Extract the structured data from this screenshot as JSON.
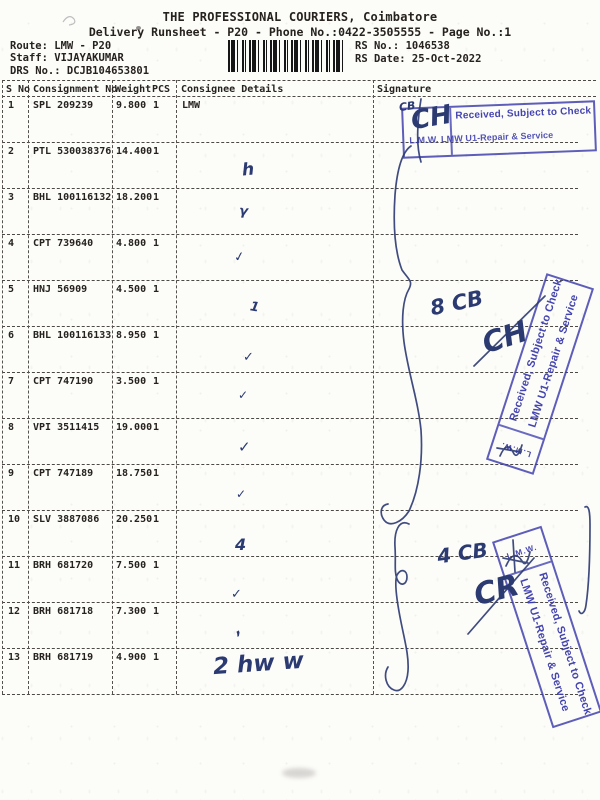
{
  "colors": {
    "stamp_blue": "#3a3aac",
    "ink_navy": "#2c3a72",
    "text": "#26221e"
  },
  "header": {
    "title": "THE PROFESSIONAL COURIERS, Coimbatore",
    "subtitle": "Delivery Runsheet - P20 - Phone No.:0422-3505555 - Page No.:1",
    "route": "Route: LMW - P20",
    "staff": "Staff: VIJAYAKUMAR",
    "drs_no": "DRS No.: DCJB104653801",
    "rs_no": "RS No.: 1046538",
    "rs_date": "RS Date: 25-Oct-2022"
  },
  "table": {
    "columns": [
      "S No",
      "Consignment No",
      "Weight",
      "PCS",
      "Consignee Details",
      "Signature"
    ],
    "rows": [
      {
        "sno": "1",
        "consignment": "SPL 209239",
        "weight": "9.800",
        "pcs": "1",
        "consignee": "LMW"
      },
      {
        "sno": "2",
        "consignment": "PTL 530038376",
        "weight": "14.400",
        "pcs": "1",
        "consignee": ""
      },
      {
        "sno": "3",
        "consignment": "BHL 100116132",
        "weight": "18.200",
        "pcs": "1",
        "consignee": ""
      },
      {
        "sno": "4",
        "consignment": "CPT 739640",
        "weight": "4.800",
        "pcs": "1",
        "consignee": ""
      },
      {
        "sno": "5",
        "consignment": "HNJ 56909",
        "weight": "4.500",
        "pcs": "1",
        "consignee": ""
      },
      {
        "sno": "6",
        "consignment": "BHL 100116133",
        "weight": "8.950",
        "pcs": "1",
        "consignee": ""
      },
      {
        "sno": "7",
        "consignment": "CPT 747190",
        "weight": "3.500",
        "pcs": "1",
        "consignee": ""
      },
      {
        "sno": "8",
        "consignment": "VPI 3511415",
        "weight": "19.000",
        "pcs": "1",
        "consignee": ""
      },
      {
        "sno": "9",
        "consignment": "CPT 747189",
        "weight": "18.750",
        "pcs": "1",
        "consignee": ""
      },
      {
        "sno": "10",
        "consignment": "SLV 3887086",
        "weight": "20.250",
        "pcs": "1",
        "consignee": ""
      },
      {
        "sno": "11",
        "consignment": "BRH 681720",
        "weight": "7.500",
        "pcs": "1",
        "consignee": ""
      },
      {
        "sno": "12",
        "consignment": "BRH 681718",
        "weight": "7.300",
        "pcs": "1",
        "consignee": ""
      },
      {
        "sno": "13",
        "consignment": "BRH 681719",
        "weight": "4.900",
        "pcs": "1",
        "consignee": ""
      }
    ]
  },
  "barcode": {
    "icon": "barcode-icon"
  },
  "stamps": {
    "stamp1": {
      "line1": "Received, Subject to Check",
      "line2": "L.M.W. LMW U1-Repair & Service"
    },
    "stamp2": {
      "line1": "Received, Subject to Check",
      "line2": "LMW U1-Repair & Service",
      "end_label": "L.M.W."
    },
    "stamp3": {
      "line1": "Received, Subject to Check",
      "line2": "LMW U1-Repair & Service",
      "end_label": "L.M.W."
    }
  },
  "handwriting": {
    "notes": [
      {
        "text": "CB",
        "x": 399,
        "y": 100,
        "size": 11,
        "rot": -8
      },
      {
        "text": "CH",
        "x": 411,
        "y": 103,
        "size": 26,
        "rot": -10
      },
      {
        "text": "8 CB",
        "x": 430,
        "y": 291,
        "size": 21,
        "rot": -12
      },
      {
        "text": "CH",
        "x": 482,
        "y": 320,
        "size": 29,
        "rot": -18
      },
      {
        "text": "4 CB",
        "x": 437,
        "y": 541,
        "size": 20,
        "rot": -8
      },
      {
        "text": "CR",
        "x": 474,
        "y": 573,
        "size": 30,
        "rot": -15
      },
      {
        "text": "2 hw w",
        "x": 213,
        "y": 651,
        "size": 23,
        "rot": -4
      }
    ],
    "ticks": [
      {
        "glyph": "h",
        "x": 242,
        "y": 160,
        "size": 17,
        "rot": -5
      },
      {
        "glyph": "γ",
        "x": 239,
        "y": 204,
        "size": 13,
        "rot": 5
      },
      {
        "glyph": "✓",
        "x": 234,
        "y": 250,
        "size": 13,
        "rot": -10
      },
      {
        "glyph": "1",
        "x": 250,
        "y": 300,
        "size": 13,
        "rot": 10
      },
      {
        "glyph": "✓",
        "x": 243,
        "y": 350,
        "size": 13,
        "rot": 0
      },
      {
        "glyph": "✓",
        "x": 238,
        "y": 388,
        "size": 12,
        "rot": 0
      },
      {
        "glyph": "✓",
        "x": 238,
        "y": 438,
        "size": 15,
        "rot": 0
      },
      {
        "glyph": "✓",
        "x": 236,
        "y": 487,
        "size": 12,
        "rot": 0
      },
      {
        "glyph": "4",
        "x": 235,
        "y": 535,
        "size": 16,
        "rot": 0
      },
      {
        "glyph": "✓",
        "x": 231,
        "y": 587,
        "size": 13,
        "rot": 0
      },
      {
        "glyph": ",",
        "x": 234,
        "y": 620,
        "size": 15,
        "rot": -30
      }
    ]
  }
}
